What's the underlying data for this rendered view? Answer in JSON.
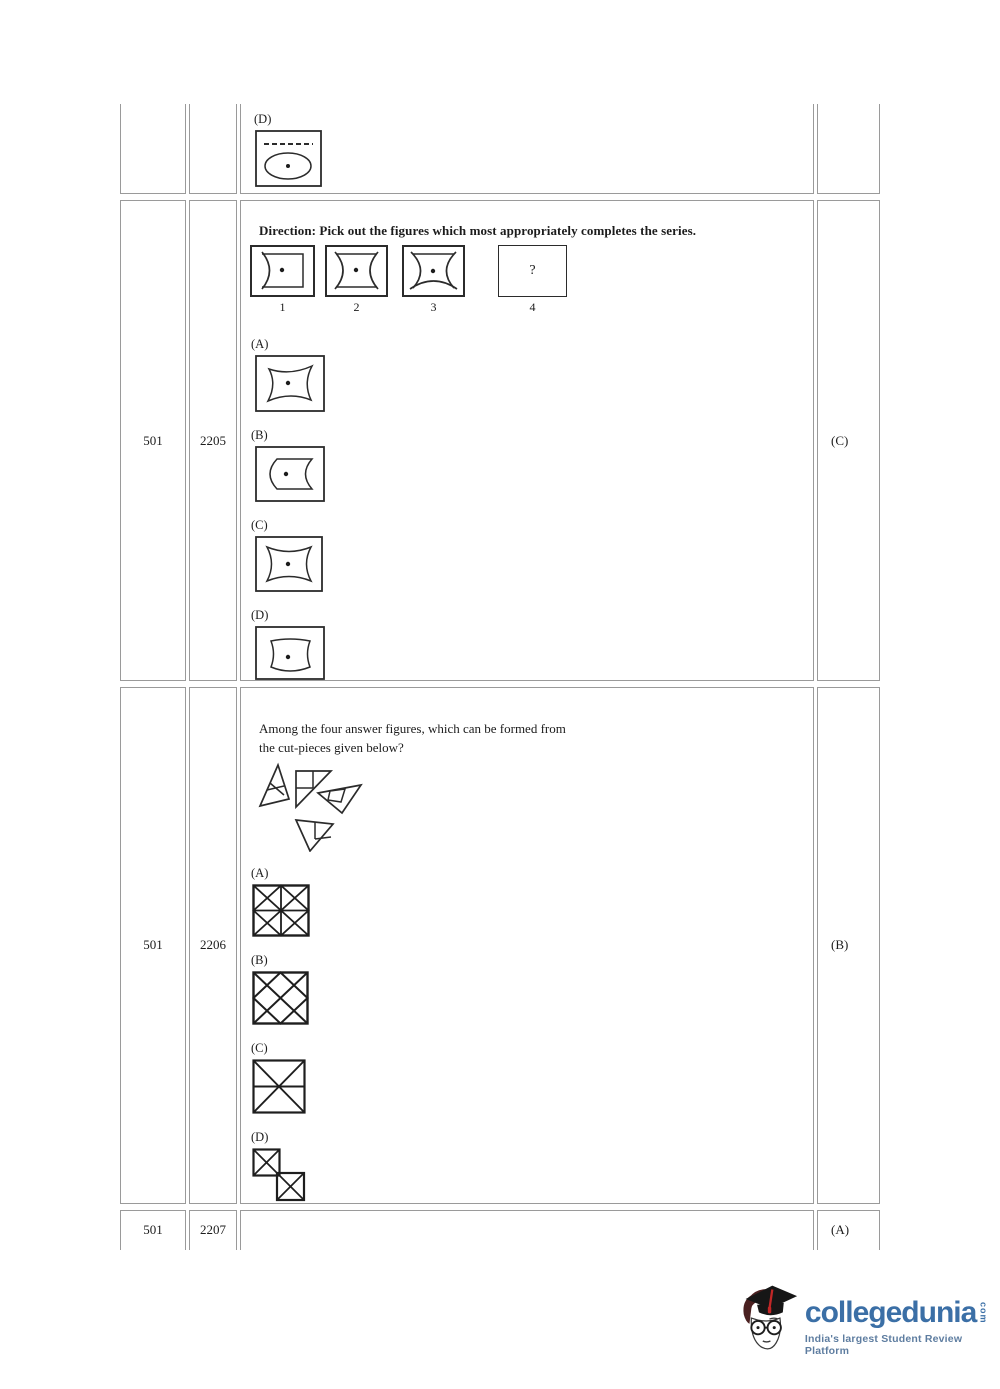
{
  "table": {
    "rows": [
      {
        "sr": "",
        "qno": "",
        "answer": ""
      },
      {
        "sr": "501",
        "qno": "2205",
        "answer": "(C)"
      },
      {
        "sr": "501",
        "qno": "2206",
        "answer": "(B)"
      },
      {
        "sr": "501",
        "qno": "2207",
        "answer": "(A)"
      }
    ]
  },
  "partial_question": {
    "option_d_label": "(D)"
  },
  "q2205": {
    "direction": "Direction: Pick out the figures which most appropriately completes the series.",
    "series_numbers": [
      "1",
      "2",
      "3",
      "4"
    ],
    "placeholder_mark": "?",
    "option_labels": [
      "(A)",
      "(B)",
      "(C)",
      "(D)"
    ]
  },
  "q2206": {
    "line1": "Among the four answer figures, which can be formed from",
    "line2": "the cut-pieces given below?",
    "option_labels": [
      "(A)",
      "(B)",
      "(C)",
      "(D)"
    ]
  },
  "footer_logo": {
    "brand": "collegedunia",
    "tld": "com",
    "tagline": "India's largest Student Review Platform",
    "brand_color": "#3b6fa6",
    "tagline_color": "#5e7da0"
  }
}
